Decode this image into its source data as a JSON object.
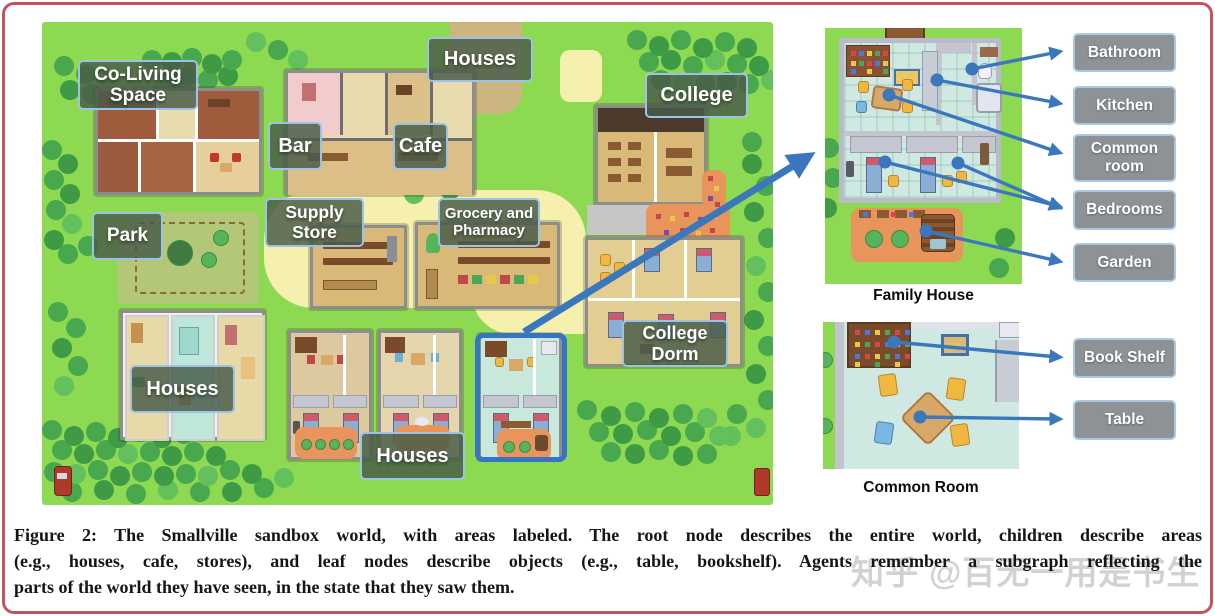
{
  "map": {
    "labels": {
      "co_living_space": "Co-Living Space",
      "houses_north": "Houses",
      "college": "College",
      "bar": "Bar",
      "cafe": "Cafe",
      "supply_store": "Supply Store",
      "grocery_pharmacy": "Grocery and Pharmacy",
      "park": "Park",
      "college_dorm": "College Dorm",
      "houses_west": "Houses",
      "houses_south": "Houses"
    }
  },
  "family_house": {
    "caption": "Family House",
    "labels": [
      "Bathroom",
      "Kitchen",
      "Common room",
      "Bedrooms",
      "Garden"
    ]
  },
  "common_room": {
    "caption": "Common Room",
    "labels": [
      "Book Shelf",
      "Table"
    ]
  },
  "figure": {
    "caption_lines": [
      "Figure 2: The Smallville sandbox world, with areas labeled. The root node describes the entire world, children describe areas",
      "(e.g., houses, cafe, stores), and leaf nodes describe objects (e.g., table, bookshelf). Agents remember a subgraph reflecting the",
      "parts of the world they have seen, in the state that they saw them."
    ],
    "watermark": "知乎 @百无一用是书生"
  },
  "colors": {
    "arrow_blue": "#3b77bd",
    "highlight_blue": "#3575c4",
    "frame_border": "#c5525e",
    "map_label_border": "#9cc3e5",
    "panel_label_bg": "#8e9294",
    "grass_green": "#8dda52",
    "path_yellow": "#f6f0ae"
  }
}
